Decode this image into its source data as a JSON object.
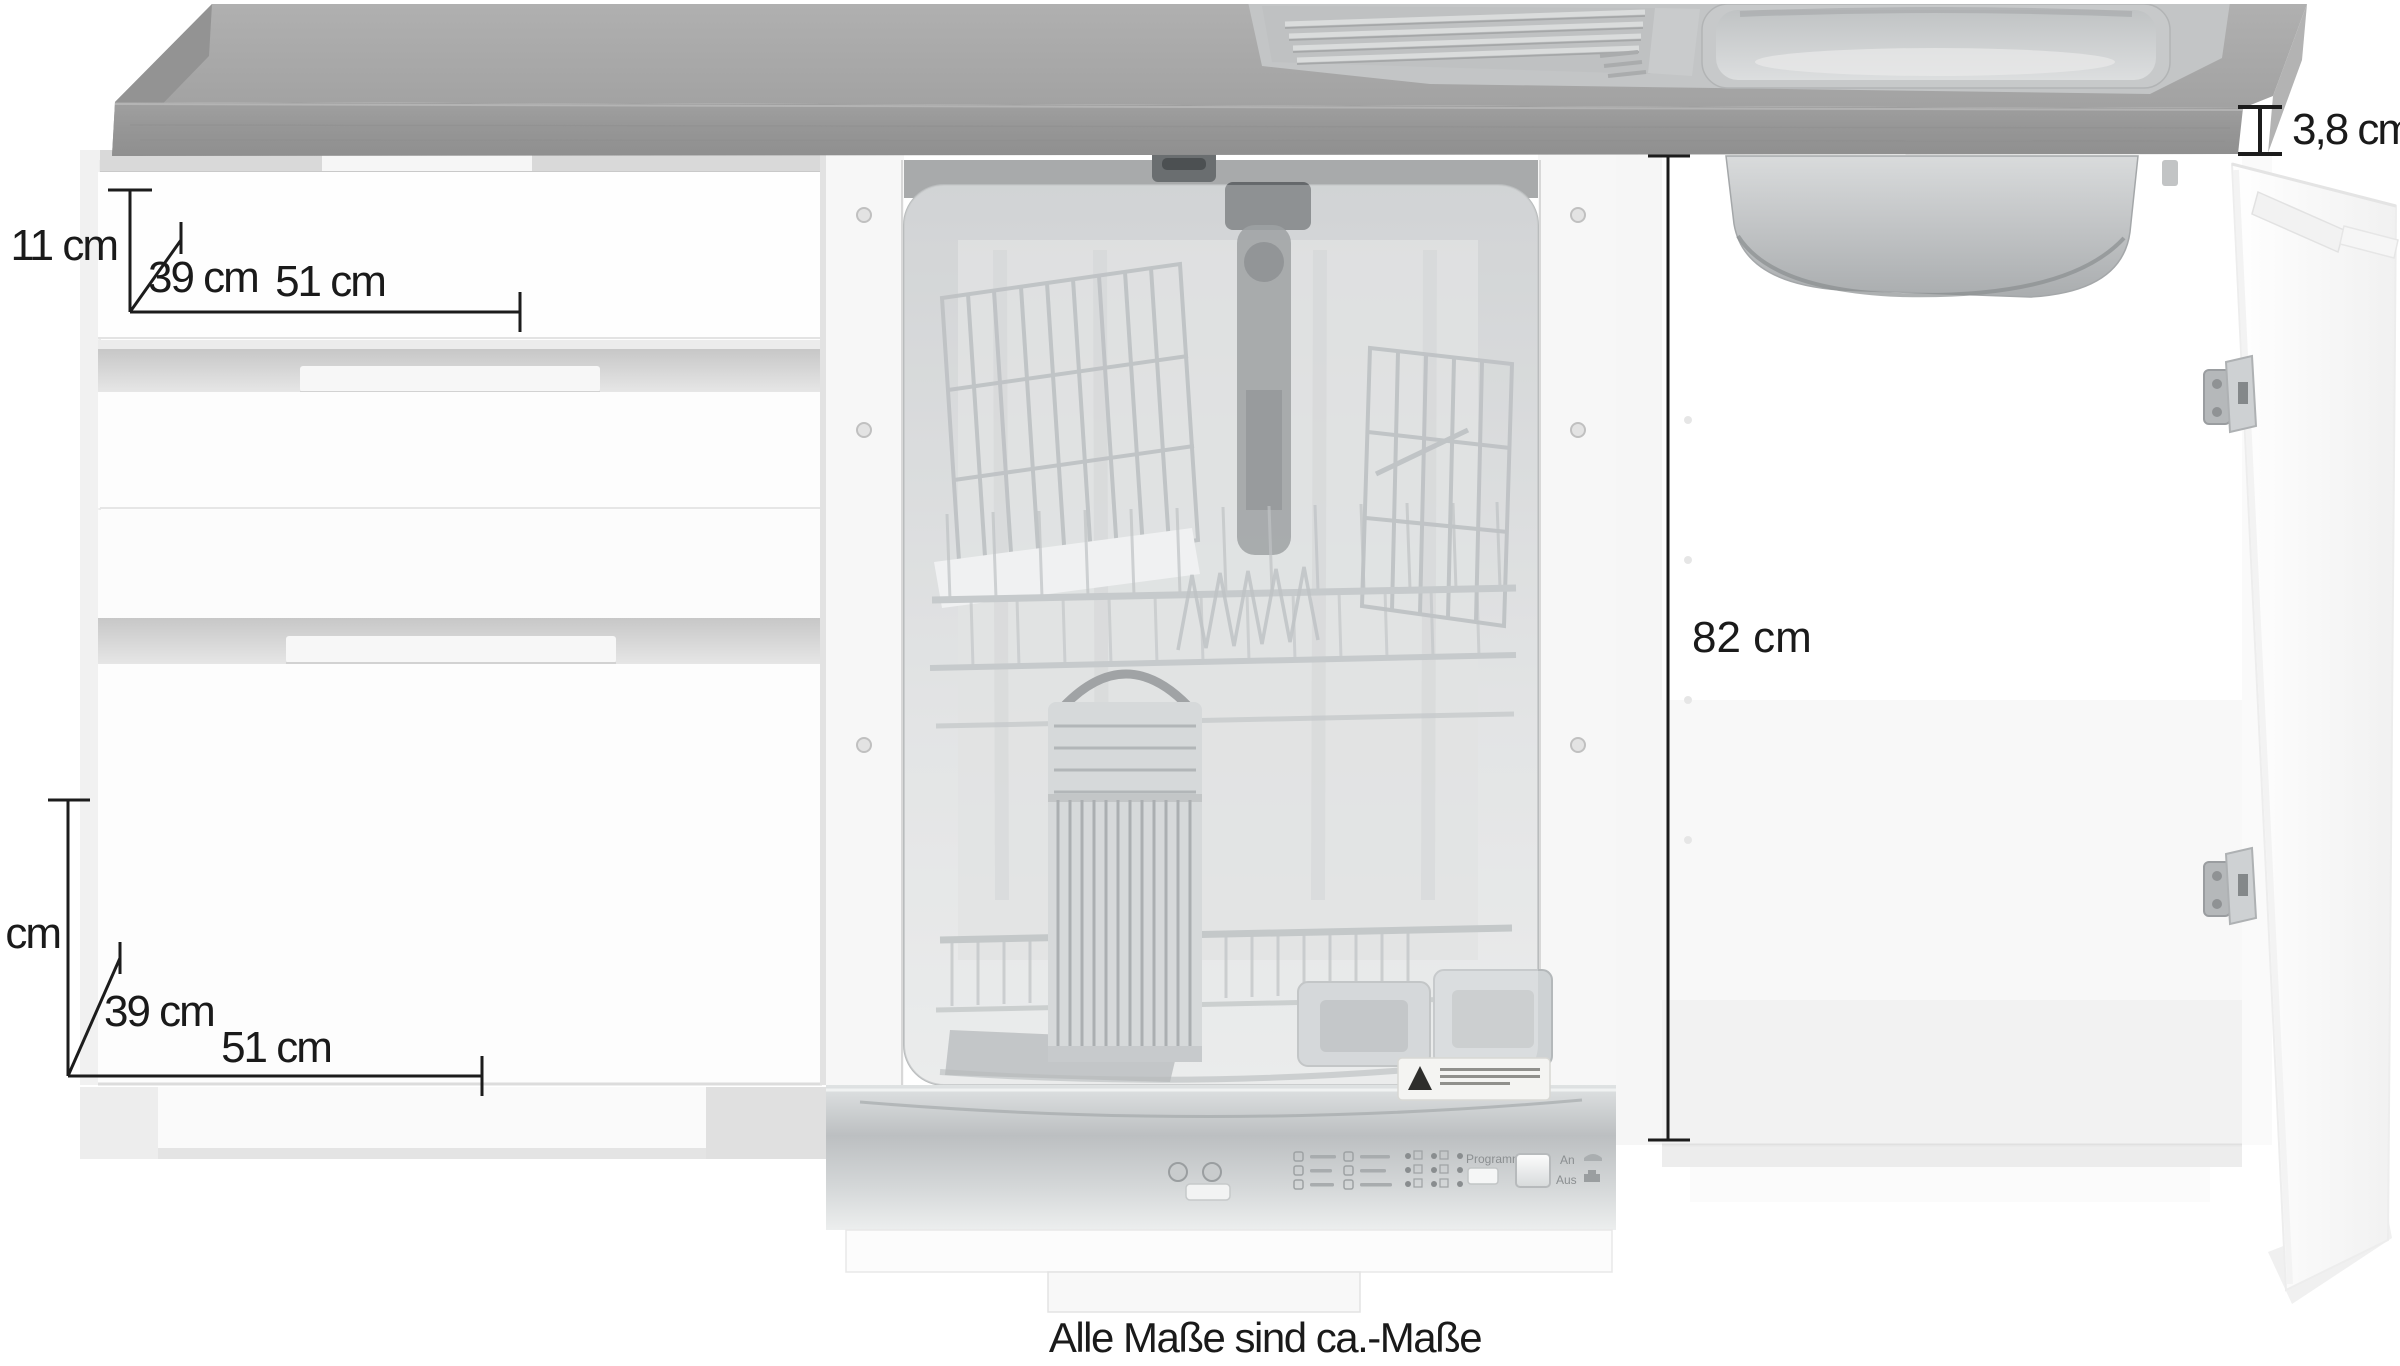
{
  "page": {
    "caption": "Alle Maße sind ca.-Maße"
  },
  "dimensions": {
    "top_drawer": {
      "height": "11 cm",
      "depth": "39 cm",
      "width": "51 cm"
    },
    "bottom_drawer": {
      "height": "22 cm",
      "depth": "39 cm",
      "width": "51 cm"
    },
    "interior_height": "82 cm",
    "worktop_thickness": "3,8 cm"
  },
  "dishwasher_panel": {
    "program": "Programm",
    "on": "An",
    "off": "Aus"
  },
  "colors": {
    "worktop_top": "#a8a8a8",
    "worktop_front": "#9a9a9a",
    "dimension_line": "#1c1c1c",
    "steel": "#c9ccce",
    "cabinet": "#fdfdfd",
    "background": "#ffffff"
  }
}
